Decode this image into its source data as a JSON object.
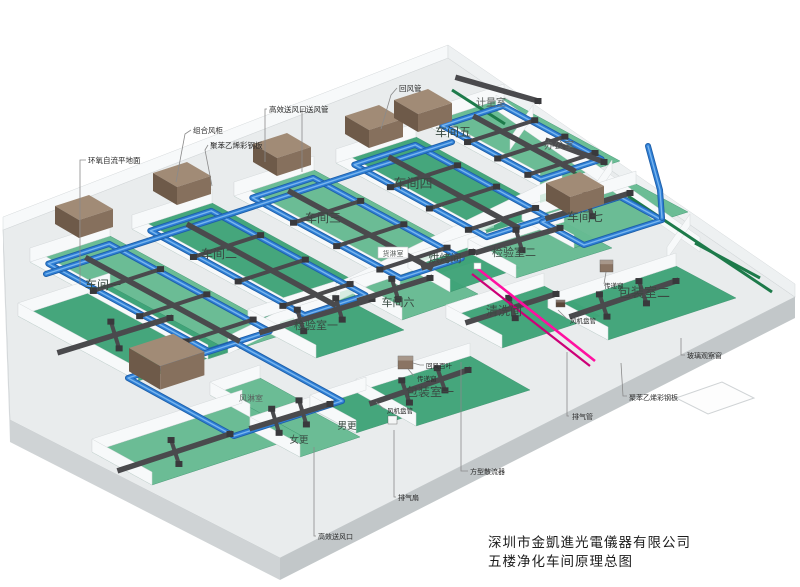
{
  "title_block": {
    "company": "深圳市金凱進光電儀器有限公司",
    "drawing": "五楼净化车间原理总图"
  },
  "rooms": {
    "workshop1": "车间一",
    "workshop2": "车间二",
    "workshop3": "车间三",
    "workshop4": "车间四",
    "workshop5": "车间五",
    "workshop6": "车间六",
    "workshop7": "车间七",
    "inspection1": "检验室一",
    "inspection2": "检验室二",
    "cleaning": "清洗间",
    "baking": "烘烤间",
    "packing1": "包装室一",
    "packing2": "包装室二",
    "metrology": "计量室",
    "office": "办公室",
    "cargo_shower": "货淋室",
    "air_shower": "风淋室",
    "women_change": "女更",
    "men_change": "男更"
  },
  "callouts": {
    "epoxy_floor": "环氧自流平地面",
    "combined_ahu": "组合风柜",
    "polystyrene_panel": "聚苯乙烯彩钢板",
    "hepa_outlet_top": "高效送风口",
    "supply_duct": "送风管",
    "return_duct": "回风管",
    "return_louver": "回风百叶",
    "transfer_window1": "传递窗",
    "fan_coil1": "风机盘管",
    "square_diffuser": "方型散流器",
    "exhaust_fan": "排气扇",
    "hepa_outlet_bottom": "高效送风口",
    "exhaust_pipe": "排气管",
    "polystyrene_panel_right": "聚苯乙烯彩钢板",
    "glass_window": "玻璃观察窗",
    "transfer_window2": "传递窗",
    "fan_coil2": "风机盘管"
  },
  "colors": {
    "floor_green": "#3fa478",
    "floor_green_light": "#66bb92",
    "conveyor_green": "#1d7a4a",
    "pipe_blue": "#2e7fd6",
    "pipe_blue_light": "#7ab6ee",
    "duct_gray": "#4a4a4d",
    "duct_dark": "#39393c",
    "ahu_top": "#a18b76",
    "ahu_front": "#6e5a49",
    "ahu_side": "#86705d",
    "exhaust_pink": "#ff10a0",
    "exhaust_pink_dark": "#cc0077",
    "slab_top": "#e9eced",
    "slab_front": "#cfd3d5",
    "slab_front_dark": "#c2c7c9",
    "wall_white": "#f7f9fa",
    "wall_edge": "#d5d9db",
    "window_green": "#bfe2d0",
    "leader_gray": "#8a8a8a"
  }
}
